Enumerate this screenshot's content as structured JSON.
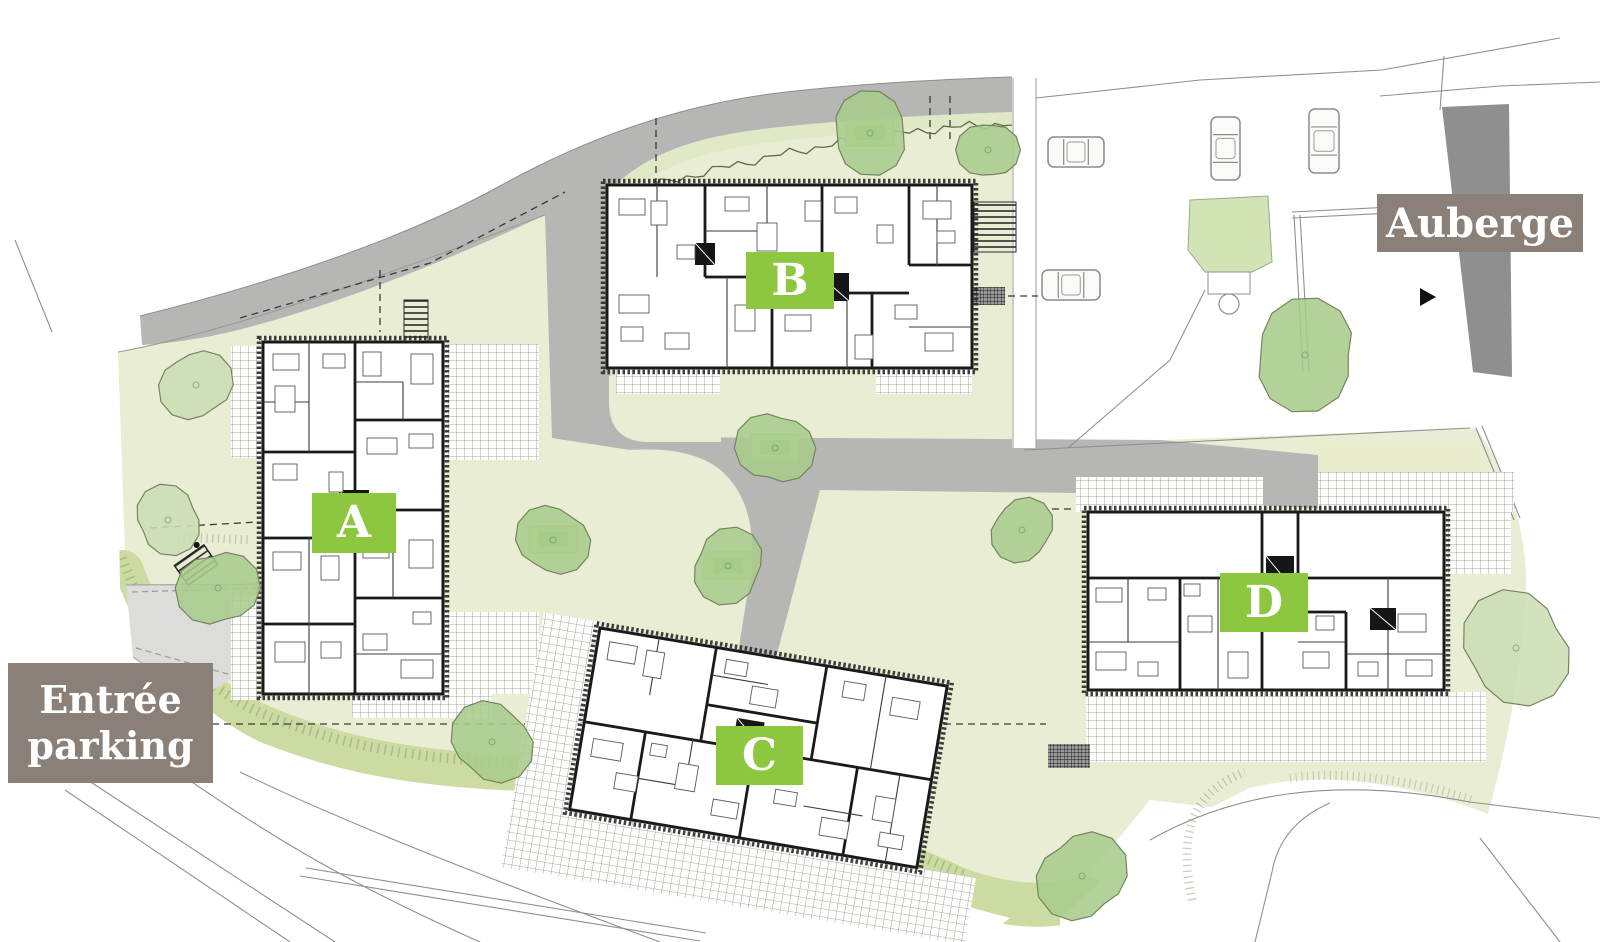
{
  "map": {
    "badges": [
      {
        "id": "A",
        "label": "A"
      },
      {
        "id": "B",
        "label": "B"
      },
      {
        "id": "C",
        "label": "C"
      },
      {
        "id": "D",
        "label": "D"
      }
    ],
    "annotations": {
      "auberge": "Auberge",
      "entree_line1": "Entrée",
      "entree_line2": "parking"
    },
    "colors": {
      "badge_green": "#8dc63f",
      "annotation_bg": "#8a8078",
      "lawn": "#e9edd3",
      "lawn_band": "#ccdba2",
      "verge": "#dfe9c6",
      "road": "#b6b6b4",
      "driveway": "#dcdcda",
      "auberge_building": "#8f8f8f",
      "tree": "#a9cc8c",
      "tree_pale": "#cbdeb4",
      "plan_wall": "#1a1a1a"
    },
    "trees": [
      {
        "x": 196,
        "y": 385,
        "r": 36,
        "shade": "p"
      },
      {
        "x": 168,
        "y": 520,
        "r": 34,
        "shade": "p"
      },
      {
        "x": 218,
        "y": 588,
        "r": 40,
        "shade": "m"
      },
      {
        "x": 870,
        "y": 133,
        "r": 40,
        "shade": "m",
        "bench": true
      },
      {
        "x": 988,
        "y": 150,
        "r": 30,
        "shade": "m"
      },
      {
        "x": 1305,
        "y": 355,
        "r": 54,
        "shade": "m"
      },
      {
        "x": 775,
        "y": 448,
        "r": 38,
        "shade": "m",
        "bench": true
      },
      {
        "x": 728,
        "y": 566,
        "r": 37,
        "shade": "m",
        "bench": true
      },
      {
        "x": 553,
        "y": 540,
        "r": 36,
        "shade": "m",
        "bench": true
      },
      {
        "x": 1022,
        "y": 530,
        "r": 32,
        "shade": "m"
      },
      {
        "x": 492,
        "y": 742,
        "r": 41,
        "shade": "m"
      },
      {
        "x": 1082,
        "y": 876,
        "r": 45,
        "shade": "m"
      },
      {
        "x": 1516,
        "y": 648,
        "r": 56,
        "shade": "p"
      }
    ],
    "cars": [
      {
        "x": 1048,
        "y": 137,
        "w": 56,
        "h": 30
      },
      {
        "x": 1042,
        "y": 270,
        "w": 58,
        "h": 30
      },
      {
        "x": 1211,
        "y": 117,
        "w": 29,
        "h": 63
      },
      {
        "x": 1309,
        "y": 109,
        "w": 30,
        "h": 64
      }
    ]
  }
}
